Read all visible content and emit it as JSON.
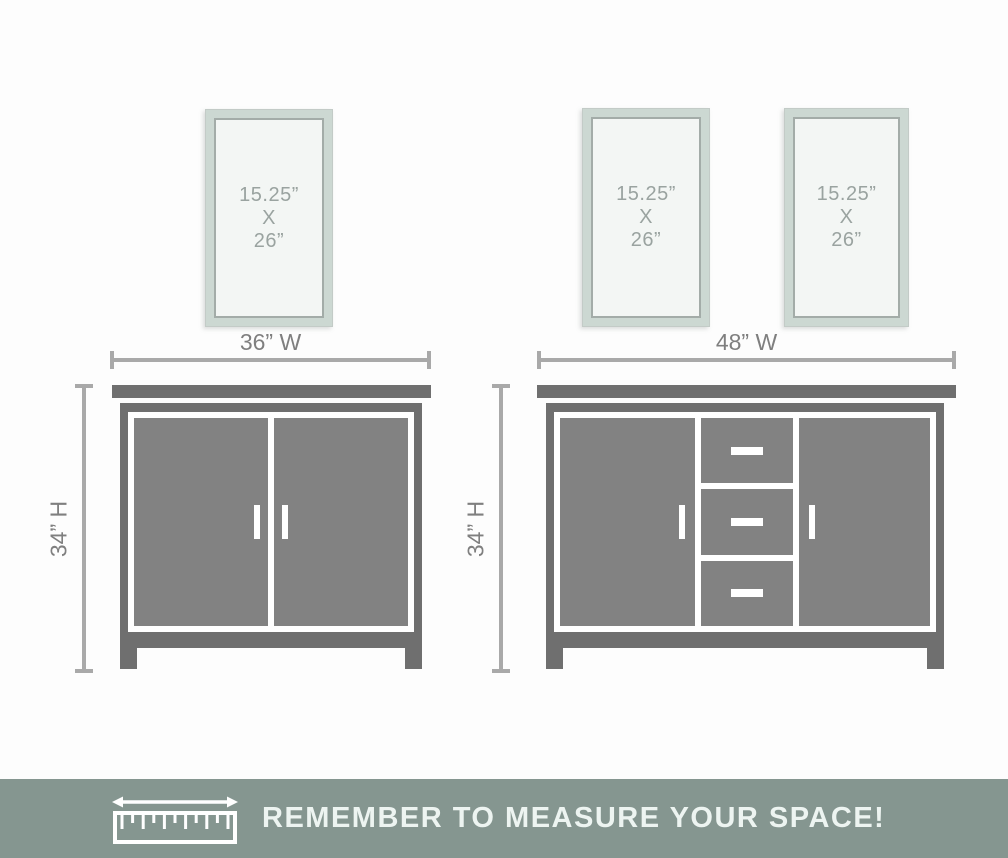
{
  "mirrors": [
    {
      "line1": "15.25”",
      "line2": "X",
      "line3": "26”"
    },
    {
      "line1": "15.25”",
      "line2": "X",
      "line3": "26”"
    },
    {
      "line1": "15.25”",
      "line2": "X",
      "line3": "26”"
    }
  ],
  "dimensions": {
    "small_vanity_width": "36” W",
    "large_vanity_width": "48” W",
    "small_vanity_height": "34” H",
    "large_vanity_height": "34” H"
  },
  "banner": {
    "text": "REMEMBER TO MEASURE YOUR SPACE!",
    "icon": "ruler-with-double-arrow"
  },
  "colors": {
    "background": "#fdfdfd",
    "vanity_frame": "#6f6f6f",
    "vanity_door": "#828282",
    "mirror_frame": "#ccd8d2",
    "mirror_glass": "#f3f6f4",
    "mirror_text": "#9aa3a0",
    "dimension_line": "#a9a9a9",
    "dimension_text": "#7f7f7f",
    "banner_background": "#859690",
    "banner_text": "#edf4f1"
  }
}
